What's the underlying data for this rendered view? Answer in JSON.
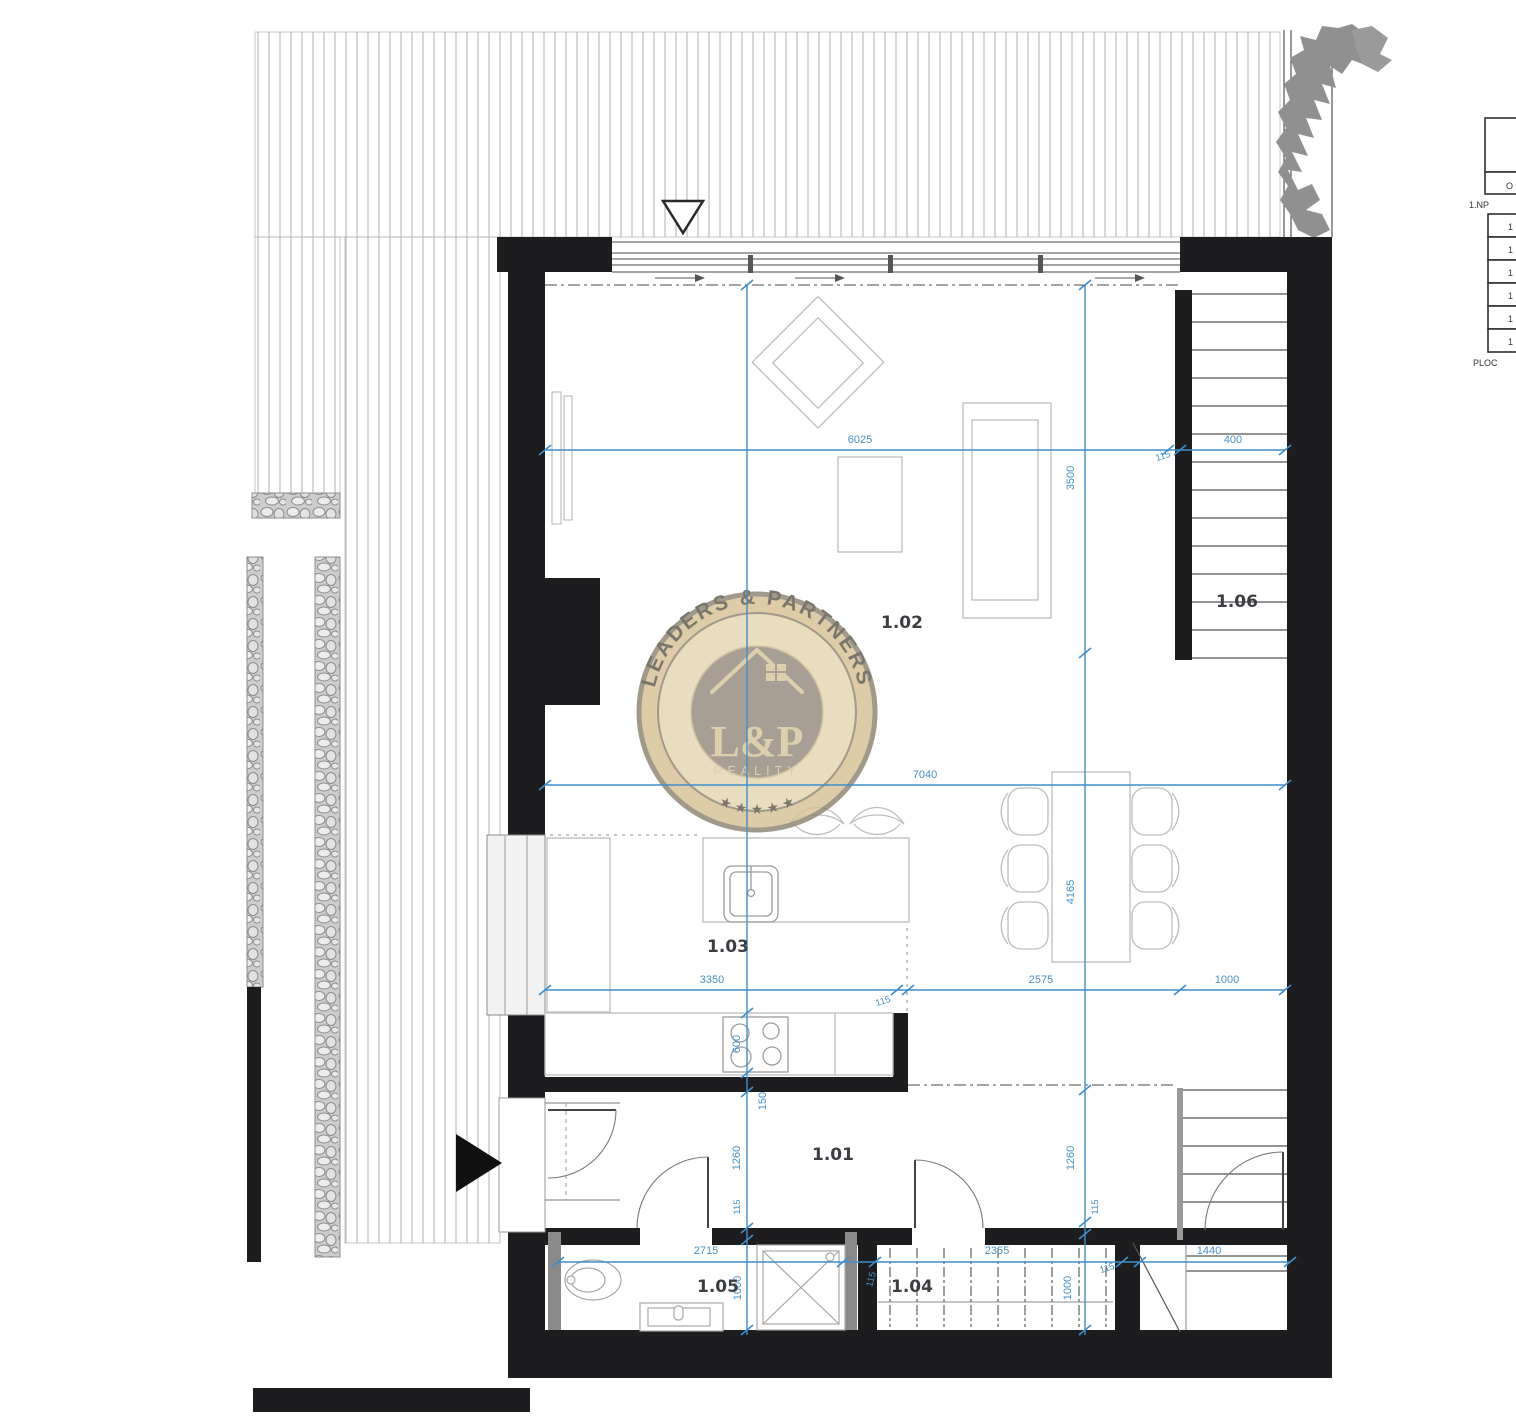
{
  "rooms": {
    "hallway": "1.01",
    "living": "1.02",
    "kitchen": "1.03",
    "wardrobe": "1.04",
    "bathroom": "1.05",
    "staircase": "1.06"
  },
  "dims": {
    "w6025": "6025",
    "w400": "400",
    "n115a": "115",
    "w7040": "7040",
    "w3350": "3350",
    "n115b": "115",
    "w2575": "2575",
    "w1000a": "1000",
    "w2715": "2715",
    "w2355": "2355",
    "n115c": "115",
    "w1440": "1440",
    "h3500": "3500",
    "h4165": "4165",
    "h600": "600",
    "h150": "150",
    "h1260a": "1260",
    "n115d": "115",
    "h1000a": "1000",
    "h1260b": "1260",
    "n115e": "115",
    "h1000b": "1000",
    "n115f": "115"
  },
  "watermark": {
    "arc_text": "LEADERS & PARTNERS",
    "monogram": "L&P",
    "caption": "REALITY",
    "stars": "★ ★ ★ ★ ★"
  },
  "legend": {
    "floor_label": "1.NP",
    "area_label": "PLOC",
    "header_cell": "O",
    "rows": [
      "1",
      "1",
      "1",
      "1",
      "1",
      "1"
    ]
  },
  "colors": {
    "dimension_blue": "#3f8ecb",
    "wall_black": "#1d1d1f",
    "badge_gold": "#d7c197",
    "badge_gray": "#968e7f"
  }
}
